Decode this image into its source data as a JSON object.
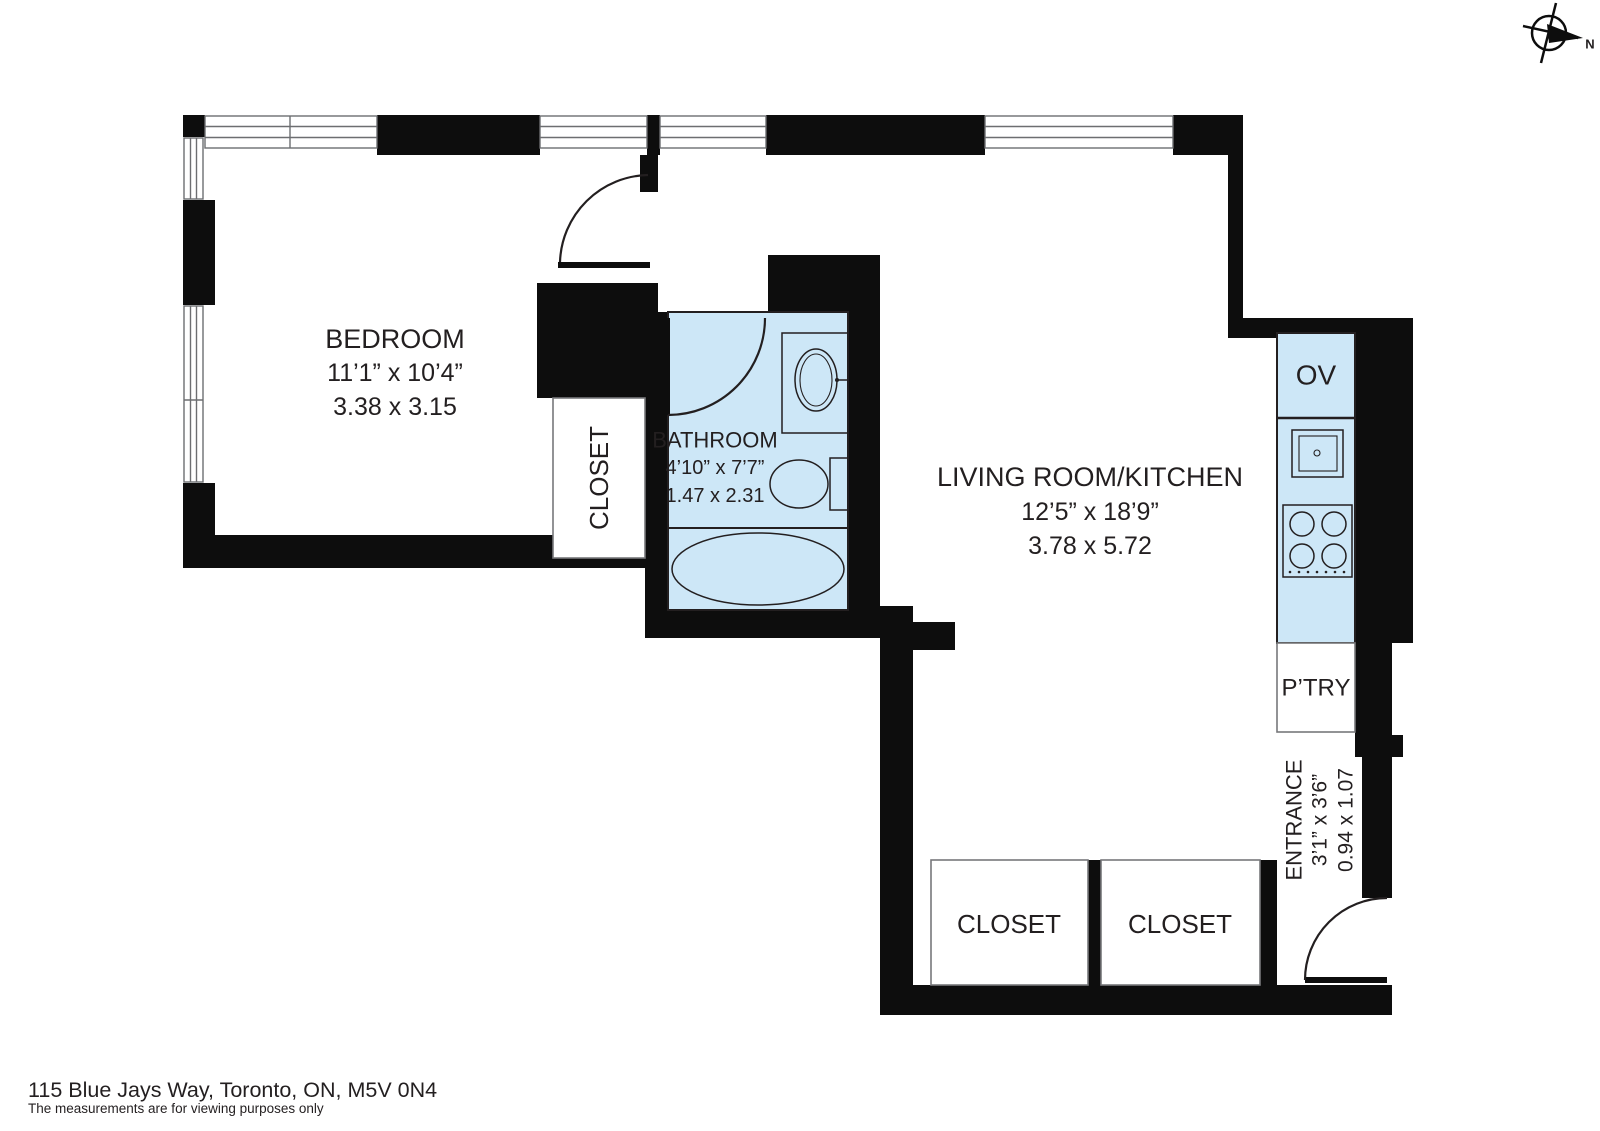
{
  "footer": {
    "address": "115 Blue Jays Way, Toronto, ON, M5V 0N4",
    "disclaimer": "The measurements are for viewing purposes only"
  },
  "compass": {
    "north": "N"
  },
  "rooms": {
    "bedroom": {
      "name": "BEDROOM",
      "size_imperial": "11’1” x 10’4”",
      "size_metric": "3.38 x 3.15"
    },
    "bathroom": {
      "name": "BATHROOM",
      "size_imperial": "4’10” x 7’7”",
      "size_metric": "1.47 x 2.31"
    },
    "living_kitchen": {
      "name": "LIVING ROOM/KITCHEN",
      "size_imperial": "12’5” x 18’9”",
      "size_metric": "3.78 x 5.72"
    },
    "entrance": {
      "name": "ENTRANCE",
      "size_imperial": "3’1” x 3’6”",
      "size_metric": "0.94 x 1.07"
    }
  },
  "labels": {
    "bedroom_closet": "CLOSET",
    "closet_left": "CLOSET",
    "closet_right": "CLOSET",
    "oven": "OV",
    "pantry": "P’TRY"
  },
  "colors": {
    "wall": "#0d0d0d",
    "fixture_fill": "#cde7f7",
    "line": "#231f20",
    "window_line": "#6d6e71",
    "box_border": "#77787b"
  }
}
